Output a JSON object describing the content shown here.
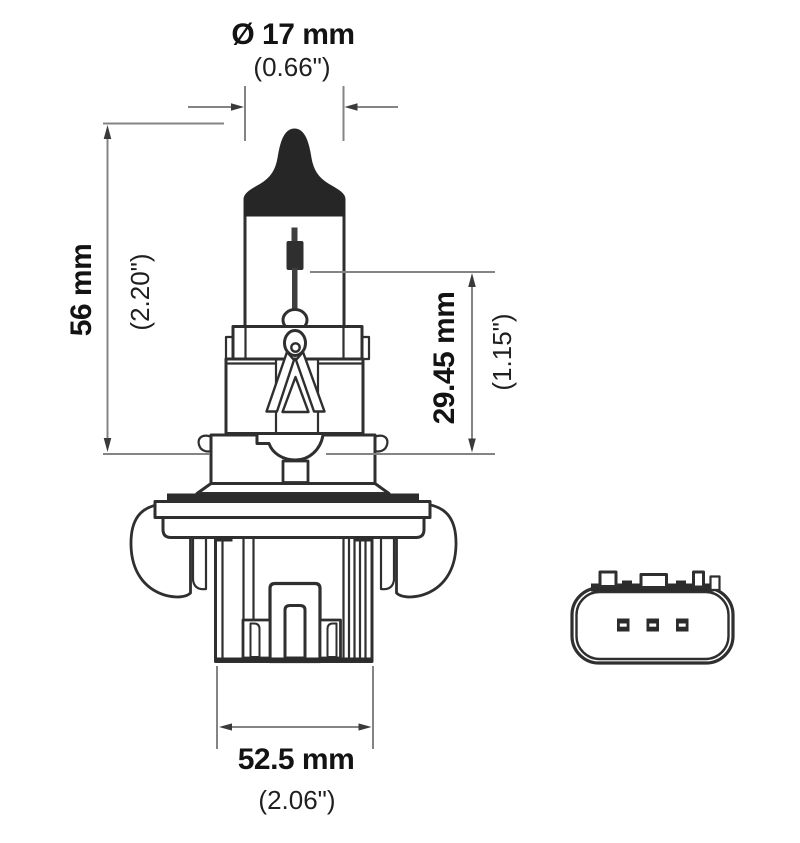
{
  "diagram": {
    "labels": {
      "diameter_mm": "Ø 17 mm",
      "diameter_in": "(0.66\")",
      "length_mm": "56 mm",
      "length_in": "(2.20\")",
      "seat_mm": "29.45 mm",
      "seat_in": "(1.15\")",
      "width_mm": "52.5 mm",
      "width_in": "(2.06\")"
    }
  }
}
